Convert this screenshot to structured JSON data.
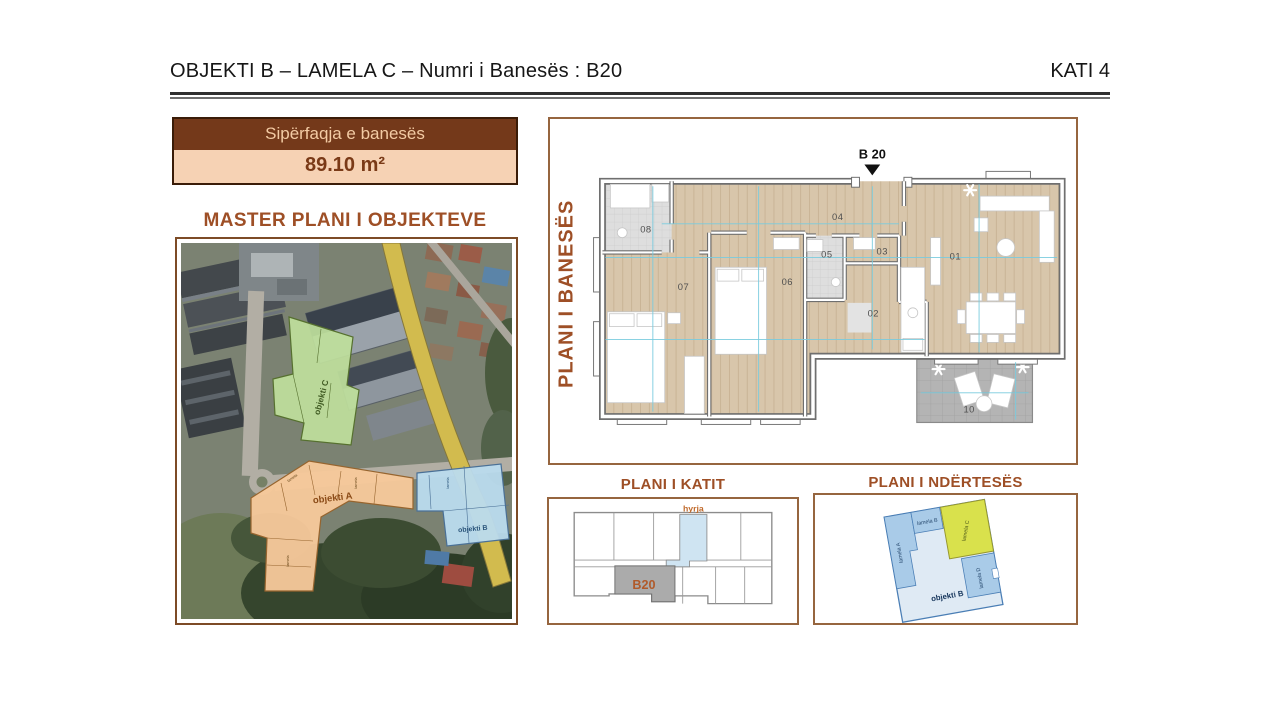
{
  "header": {
    "title": "OBJEKTI B – LAMELA C – Numri i Banesës : B20",
    "floor_label": "KATI 4"
  },
  "area_box": {
    "label": "Sipërfaqja e banesës",
    "value": "89.10 m²"
  },
  "master_plan": {
    "title": "MASTER PLANI I OBJEKTEVE",
    "objekti_a": "objekti A",
    "objekti_b": "objekti B",
    "objekti_c": "objekti C",
    "lamela_micro": "lamela"
  },
  "apartment_plan": {
    "side_label": "PLANI I BANESËS",
    "unit_marker": "B 20",
    "rooms": {
      "r01": "01",
      "r02": "02",
      "r03": "03",
      "r04": "04",
      "r05": "05",
      "r06": "06",
      "r07": "07",
      "r08": "08",
      "r10": "10"
    }
  },
  "floor_plan": {
    "title": "PLANI I KATIT",
    "entrance": "hyrja",
    "unit": "B20"
  },
  "building_plan": {
    "title": "PLANI I NDËRTESËS",
    "objekti_b": "objekti B",
    "lamela_a": "lamela A",
    "lamela_b": "lamela B",
    "lamela_c": "lamela C",
    "lamela_d": "lamela D"
  },
  "colors": {
    "brown_dark": "#74391a",
    "peach": "#f6d2b4",
    "rust": "#9e4f26",
    "accent_orange": "#c06a2c",
    "highlight_yellow": "#d9e14c",
    "overlay_green": "#bfe09c",
    "overlay_orange": "#f8c99b",
    "overlay_blue": "#badbee"
  }
}
